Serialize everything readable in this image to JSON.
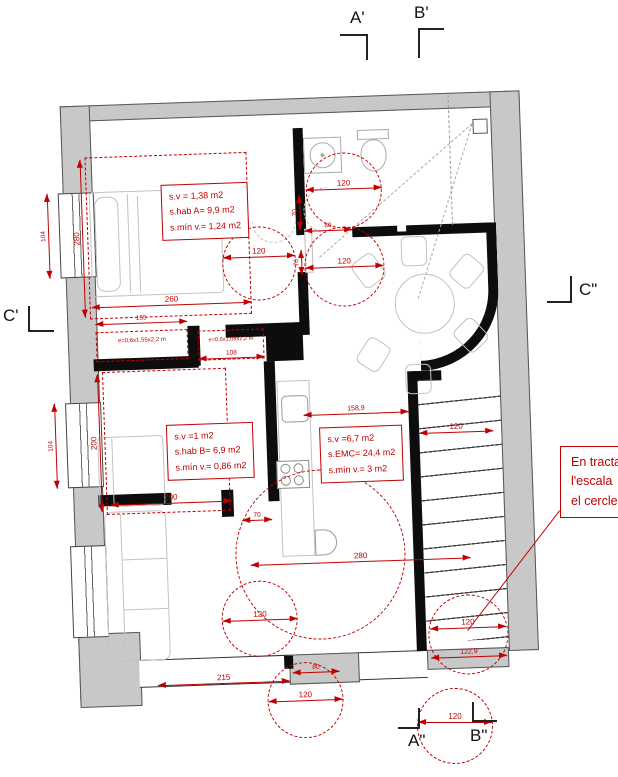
{
  "markers": {
    "top_left": "A'",
    "top_right": "B'",
    "left": "C'",
    "right": "C\"",
    "bottom_left": "A\"",
    "bottom_right": "B\""
  },
  "rooms": {
    "bedroom_a": {
      "l1": "s.v = 1,38 m2",
      "l2": "s.hab A= 9,9 m2",
      "l3": "s.mín v.= 1,24 m2"
    },
    "bedroom_b": {
      "l1": "s.v =1 m2",
      "l2": "s.hab B= 6,9 m2",
      "l3": "s.mín v.= 0,86 m2"
    },
    "living_kitchen": {
      "l1": "s.v =6,7 m2",
      "l2": "s.EMC= 24,4 m2",
      "l3": "s.mín v.= 3 m2"
    },
    "closet_a": "e=0,6x1,55x2,2 m",
    "closet_b": "e=0,6x1,08x2,2 m"
  },
  "note": {
    "l1": "En tracta",
    "l2": "l'escala",
    "l3": "el cercle"
  },
  "dims": {
    "bedA_h": "280",
    "bedA_w": "260",
    "closetA_w": "155",
    "win1_h": "104",
    "win2_h": "104",
    "bedB_h": "200",
    "bedB_w": "200",
    "closetB_w": "108",
    "hall_circle": "120",
    "bath_circle": "120",
    "hall2_circle": "120",
    "bath_door": "80",
    "bath_off1": "70",
    "bath_off2": "70",
    "living_len": "158,9",
    "stairs_top": "120",
    "bedB_door": "70",
    "living_w": "280",
    "bottom_left_w": "215",
    "bottom_door": "80",
    "sofa_circle": "120",
    "entry_circle": "120",
    "stairs_circle": "120",
    "stairs_w": "122,9",
    "section_circle": "120"
  },
  "colors": {
    "annotation": "#c00000",
    "outer_wall": "#c8c8c8",
    "inner_wall": "#0d0d0d"
  }
}
